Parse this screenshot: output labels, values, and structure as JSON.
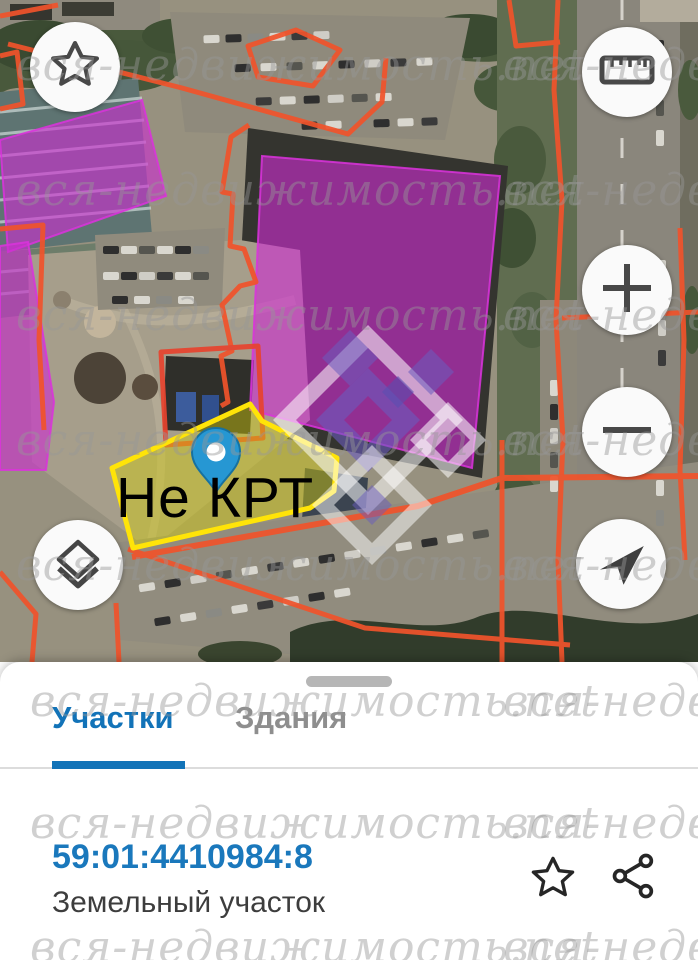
{
  "watermark": {
    "text": "вся-недвижимость.net"
  },
  "map": {
    "selected_parcel_label": "Не КРТ",
    "selected_parcel_color": "#ffe408",
    "highlight_color": "#c92ccb",
    "cadastral_line_color": "#f1532b",
    "pin_color": "#2697d3"
  },
  "controls": {
    "favorite": "star-icon",
    "measure": "ruler-icon",
    "zoom_in": "plus-icon",
    "zoom_out": "minus-icon",
    "locate": "navigation-arrow-icon",
    "layers": "layers-icon"
  },
  "sheet": {
    "tabs": {
      "parcels": "Участки",
      "buildings": "Здания"
    },
    "active_tab": "Участки",
    "accent_color": "#1273b8",
    "parcel": {
      "cadastral_number": "59:01:4410984:8",
      "type": "Земельный участок"
    },
    "actions": {
      "favorite": "star-icon",
      "share": "share-icon"
    }
  }
}
